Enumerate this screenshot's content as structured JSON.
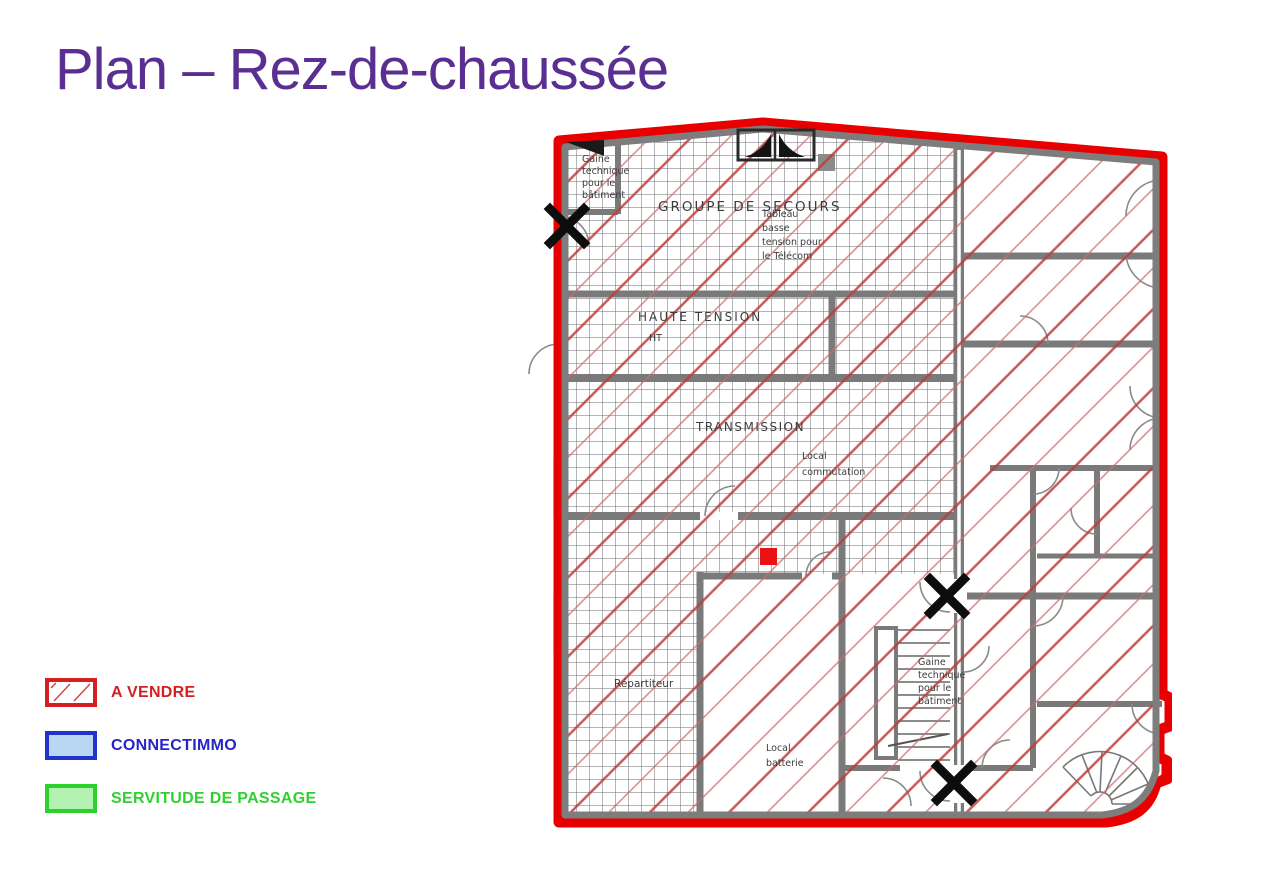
{
  "page": {
    "title": "Plan – Rez-de-chaussée"
  },
  "colors": {
    "title_purple": "#5b2f91",
    "outline_red": "#e80000",
    "wall_gray": "#7a7a7a",
    "hatch_red": "#c03a3a",
    "vendre_red": "#d42020",
    "connectimmo_blue": "#2525c8",
    "connectimmo_fill": "#b9d6f2",
    "servitude_green": "#30d030",
    "servitude_fill": "#b4f2b4",
    "marker_black": "#0d0d0d",
    "red_square": "#e91111"
  },
  "legend": {
    "items": [
      {
        "label": "A VENDRE"
      },
      {
        "label": "CONNECTIMMO"
      },
      {
        "label": "SERVITUDE DE PASSAGE"
      }
    ]
  },
  "plan": {
    "markers": {
      "x_markers": 3,
      "red_square": 1
    },
    "rooms": {
      "gaine_top": {
        "lines": [
          "Gaine",
          "technique",
          "pour le",
          "bâtiment"
        ]
      },
      "groupe_secours": {
        "label": "GROUPE DE SECOURS"
      },
      "tableau": {
        "lines": [
          "Tableau",
          "basse",
          "tension pour",
          "le Télécom"
        ]
      },
      "haute_tension": {
        "label": "HAUTE TENSION",
        "sub": "HT"
      },
      "transmission": {
        "label": "TRANSMISSION"
      },
      "local_commutation": {
        "lines": [
          "Local",
          "commutation"
        ]
      },
      "repartiteur": {
        "label": "Répartiteur"
      },
      "local_batterie": {
        "lines": [
          "Local",
          "batterie"
        ]
      },
      "gaine_bottom": {
        "lines": [
          "Gaine",
          "technique",
          "pour le",
          "bâtiment"
        ]
      }
    }
  }
}
